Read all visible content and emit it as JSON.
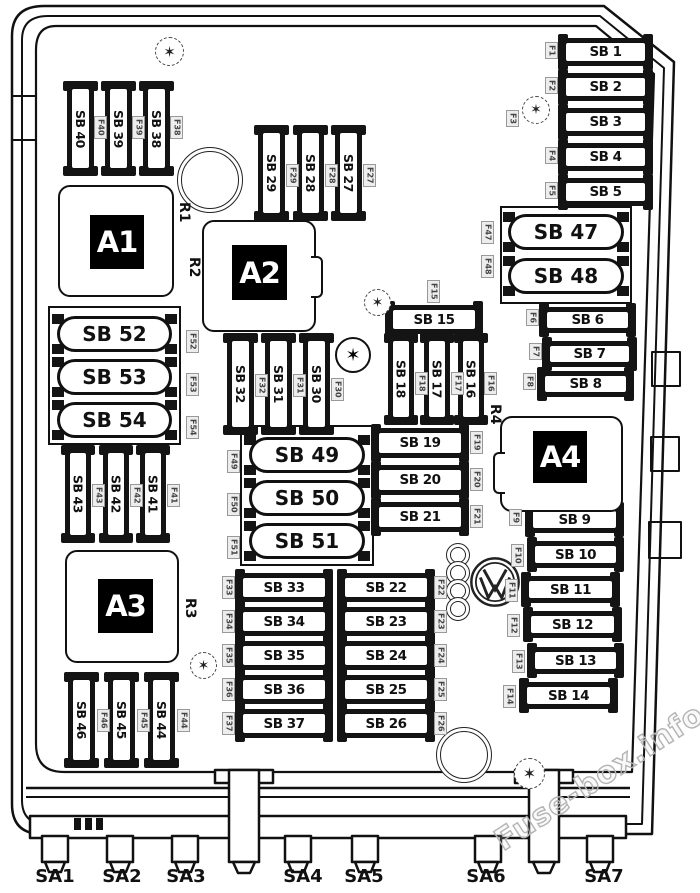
{
  "diagram": {
    "watermark": "Fuse-box.info",
    "icons": {
      "torx_glyph": "✶"
    },
    "colors": {
      "line": "#111111",
      "background": "#ffffff",
      "relay_bg": "#000000",
      "relay_text": "#ffffff",
      "id_label_bg": "#ededed",
      "id_label_text": "#444444",
      "watermark": "#b4b4b4"
    },
    "relays": [
      {
        "id": "A1",
        "x": 58,
        "y": 185,
        "w": 116,
        "h": 112,
        "cx": 30,
        "cy": 28,
        "cw": 54,
        "ch": 54
      },
      {
        "id": "A2",
        "x": 202,
        "y": 220,
        "w": 114,
        "h": 112,
        "cx": 28,
        "cy": 23,
        "cw": 55,
        "ch": 55,
        "tab": "right"
      },
      {
        "id": "A3",
        "x": 65,
        "y": 550,
        "w": 114,
        "h": 113,
        "cx": 31,
        "cy": 27,
        "cw": 55,
        "ch": 54
      },
      {
        "id": "A4",
        "x": 500,
        "y": 416,
        "w": 123,
        "h": 96,
        "cx": 31,
        "cy": 13,
        "cw": 54,
        "ch": 52,
        "tab": "left"
      }
    ],
    "relay_labels": [
      {
        "id": "R1",
        "x": 176,
        "y": 202
      },
      {
        "id": "R2",
        "x": 186,
        "y": 257
      },
      {
        "id": "R3",
        "x": 182,
        "y": 598
      },
      {
        "id": "R4",
        "x": 487,
        "y": 404
      }
    ],
    "vertical_fuses": [
      {
        "label": "SB 40",
        "x": 67,
        "y": 84,
        "w": 27,
        "h": 89,
        "f": {
          "label": "F40",
          "x": 94,
          "y": 116
        }
      },
      {
        "label": "SB 39",
        "x": 105,
        "y": 84,
        "w": 27,
        "h": 89,
        "f": {
          "label": "F39",
          "x": 132,
          "y": 116
        }
      },
      {
        "label": "SB 38",
        "x": 143,
        "y": 84,
        "w": 27,
        "h": 89,
        "f": {
          "label": "F38",
          "x": 170,
          "y": 116
        }
      },
      {
        "label": "SB 29",
        "x": 258,
        "y": 128,
        "w": 27,
        "h": 90,
        "f": {
          "label": "F29",
          "x": 286,
          "y": 164
        }
      },
      {
        "label": "SB 28",
        "x": 297,
        "y": 128,
        "w": 27,
        "h": 90,
        "f": {
          "label": "F28",
          "x": 325,
          "y": 164
        }
      },
      {
        "label": "SB 27",
        "x": 335,
        "y": 128,
        "w": 27,
        "h": 90,
        "f": {
          "label": "F27",
          "x": 363,
          "y": 164
        }
      },
      {
        "label": "SB 32",
        "x": 227,
        "y": 336,
        "w": 27,
        "h": 96,
        "f": {
          "label": "F32",
          "x": 255,
          "y": 374
        }
      },
      {
        "label": "SB 31",
        "x": 265,
        "y": 336,
        "w": 27,
        "h": 96,
        "f": {
          "label": "F31",
          "x": 293,
          "y": 374
        }
      },
      {
        "label": "SB 30",
        "x": 303,
        "y": 336,
        "w": 27,
        "h": 96,
        "f": {
          "label": "F30",
          "x": 331,
          "y": 378
        }
      },
      {
        "label": "SB 18",
        "x": 388,
        "y": 336,
        "w": 26,
        "h": 86,
        "f": {
          "label": "F18",
          "x": 415,
          "y": 372
        }
      },
      {
        "label": "SB 17",
        "x": 424,
        "y": 336,
        "w": 26,
        "h": 86,
        "f": {
          "label": "F17",
          "x": 451,
          "y": 372
        }
      },
      {
        "label": "SB 16",
        "x": 458,
        "y": 336,
        "w": 26,
        "h": 86,
        "f": {
          "label": "F16",
          "x": 484,
          "y": 372
        }
      },
      {
        "label": "SB 43",
        "x": 65,
        "y": 448,
        "w": 26,
        "h": 92,
        "f": {
          "label": "F43",
          "x": 92,
          "y": 484
        }
      },
      {
        "label": "SB 42",
        "x": 103,
        "y": 448,
        "w": 26,
        "h": 92,
        "f": {
          "label": "F42",
          "x": 130,
          "y": 484
        }
      },
      {
        "label": "SB 41",
        "x": 140,
        "y": 448,
        "w": 26,
        "h": 92,
        "f": {
          "label": "F41",
          "x": 167,
          "y": 484
        }
      },
      {
        "label": "SB 46",
        "x": 68,
        "y": 675,
        "w": 27,
        "h": 90,
        "f": {
          "label": "F46",
          "x": 97,
          "y": 709
        }
      },
      {
        "label": "SB 45",
        "x": 108,
        "y": 675,
        "w": 27,
        "h": 90,
        "f": {
          "label": "F45",
          "x": 137,
          "y": 709
        }
      },
      {
        "label": "SB 44",
        "x": 148,
        "y": 675,
        "w": 27,
        "h": 90,
        "f": {
          "label": "F44",
          "x": 177,
          "y": 709
        }
      }
    ],
    "horizontal_fuses": [
      {
        "label": "SB 1",
        "x": 561,
        "y": 38,
        "w": 89,
        "h": 28,
        "f": {
          "label": "F1",
          "x": 545,
          "y": 42
        }
      },
      {
        "label": "SB 2",
        "x": 561,
        "y": 73,
        "w": 89,
        "h": 28,
        "f": {
          "label": "F2",
          "x": 545,
          "y": 77
        }
      },
      {
        "label": "SB 3",
        "x": 561,
        "y": 108,
        "w": 89,
        "h": 28,
        "f": {
          "label": "F3",
          "x": 506,
          "y": 110
        }
      },
      {
        "label": "SB 4",
        "x": 561,
        "y": 143,
        "w": 89,
        "h": 28,
        "f": {
          "label": "F4",
          "x": 545,
          "y": 147
        }
      },
      {
        "label": "SB 5",
        "x": 561,
        "y": 178,
        "w": 89,
        "h": 28,
        "f": {
          "label": "F5",
          "x": 545,
          "y": 182
        }
      },
      {
        "label": "SB 6",
        "x": 542,
        "y": 307,
        "w": 91,
        "h": 26,
        "f": {
          "label": "F6",
          "x": 526,
          "y": 309
        }
      },
      {
        "label": "SB 7",
        "x": 545,
        "y": 341,
        "w": 89,
        "h": 26,
        "f": {
          "label": "F7",
          "x": 529,
          "y": 343
        }
      },
      {
        "label": "SB 8",
        "x": 540,
        "y": 371,
        "w": 91,
        "h": 26,
        "f": {
          "label": "F8",
          "x": 523,
          "y": 373
        }
      },
      {
        "label": "SB 15",
        "x": 388,
        "y": 305,
        "w": 92,
        "h": 29,
        "f": {
          "label": "F15",
          "x": 427,
          "y": 280
        }
      },
      {
        "label": "SB 19",
        "x": 374,
        "y": 428,
        "w": 92,
        "h": 30,
        "f": {
          "label": "F19",
          "x": 470,
          "y": 431
        }
      },
      {
        "label": "SB 20",
        "x": 374,
        "y": 465,
        "w": 92,
        "h": 30,
        "f": {
          "label": "F20",
          "x": 470,
          "y": 468
        }
      },
      {
        "label": "SB 21",
        "x": 374,
        "y": 502,
        "w": 92,
        "h": 30,
        "f": {
          "label": "F21",
          "x": 470,
          "y": 505
        }
      },
      {
        "label": "SB 33",
        "x": 238,
        "y": 573,
        "w": 92,
        "h": 29,
        "f": {
          "label": "F33",
          "x": 222,
          "y": 576
        }
      },
      {
        "label": "SB 34",
        "x": 238,
        "y": 607,
        "w": 92,
        "h": 29,
        "f": {
          "label": "F34",
          "x": 222,
          "y": 610
        }
      },
      {
        "label": "SB 35",
        "x": 238,
        "y": 641,
        "w": 92,
        "h": 29,
        "f": {
          "label": "F35",
          "x": 222,
          "y": 644
        }
      },
      {
        "label": "SB 36",
        "x": 238,
        "y": 675,
        "w": 92,
        "h": 29,
        "f": {
          "label": "F36",
          "x": 222,
          "y": 678
        }
      },
      {
        "label": "SB 37",
        "x": 238,
        "y": 709,
        "w": 92,
        "h": 29,
        "f": {
          "label": "F37",
          "x": 222,
          "y": 712
        }
      },
      {
        "label": "SB 22",
        "x": 340,
        "y": 573,
        "w": 92,
        "h": 29,
        "f": {
          "label": "F22",
          "x": 434,
          "y": 576
        }
      },
      {
        "label": "SB 23",
        "x": 340,
        "y": 607,
        "w": 92,
        "h": 29,
        "f": {
          "label": "F23",
          "x": 434,
          "y": 610
        }
      },
      {
        "label": "SB 24",
        "x": 340,
        "y": 641,
        "w": 92,
        "h": 29,
        "f": {
          "label": "F24",
          "x": 434,
          "y": 644
        }
      },
      {
        "label": "SB 25",
        "x": 340,
        "y": 675,
        "w": 92,
        "h": 29,
        "f": {
          "label": "F25",
          "x": 434,
          "y": 678
        }
      },
      {
        "label": "SB 26",
        "x": 340,
        "y": 709,
        "w": 92,
        "h": 29,
        "f": {
          "label": "F26",
          "x": 434,
          "y": 712
        }
      },
      {
        "label": "SB 9",
        "x": 528,
        "y": 506,
        "w": 93,
        "h": 27,
        "f": {
          "label": "F9",
          "x": 509,
          "y": 509
        }
      },
      {
        "label": "SB 10",
        "x": 530,
        "y": 541,
        "w": 91,
        "h": 27,
        "f": {
          "label": "F10",
          "x": 511,
          "y": 544
        }
      },
      {
        "label": "SB 11",
        "x": 524,
        "y": 576,
        "w": 93,
        "h": 27,
        "f": {
          "label": "F11",
          "x": 505,
          "y": 579
        }
      },
      {
        "label": "SB 12",
        "x": 526,
        "y": 611,
        "w": 93,
        "h": 27,
        "f": {
          "label": "F12",
          "x": 507,
          "y": 614
        }
      },
      {
        "label": "SB 13",
        "x": 530,
        "y": 647,
        "w": 91,
        "h": 27,
        "f": {
          "label": "F13",
          "x": 512,
          "y": 650
        }
      },
      {
        "label": "SB 14",
        "x": 522,
        "y": 682,
        "w": 93,
        "h": 27,
        "f": {
          "label": "F14",
          "x": 503,
          "y": 685
        }
      }
    ],
    "pill_groups": [
      {
        "id": "sb47-48",
        "x": 500,
        "y": 206,
        "w": 132,
        "h": 98,
        "pills": [
          {
            "label": "SB 47",
            "x": 508,
            "y": 214,
            "w": 116,
            "h": 36,
            "f": {
              "label": "F47",
              "x": 481,
              "y": 221
            }
          },
          {
            "label": "SB 48",
            "x": 508,
            "y": 258,
            "w": 116,
            "h": 36,
            "f": {
              "label": "F48",
              "x": 481,
              "y": 255
            }
          }
        ]
      },
      {
        "id": "sb52-54",
        "x": 48,
        "y": 306,
        "w": 133,
        "h": 139,
        "pills": [
          {
            "label": "SB 52",
            "x": 57,
            "y": 316,
            "w": 115,
            "h": 36,
            "f": {
              "label": "F52",
              "x": 186,
              "y": 330
            }
          },
          {
            "label": "SB 53",
            "x": 57,
            "y": 359,
            "w": 115,
            "h": 36,
            "f": {
              "label": "F53",
              "x": 186,
              "y": 373
            }
          },
          {
            "label": "SB 54",
            "x": 57,
            "y": 402,
            "w": 115,
            "h": 36,
            "f": {
              "label": "F54",
              "x": 186,
              "y": 416
            }
          }
        ]
      },
      {
        "id": "sb49-51",
        "x": 240,
        "y": 425,
        "w": 134,
        "h": 141,
        "pills": [
          {
            "label": "SB 49",
            "x": 249,
            "y": 437,
            "w": 116,
            "h": 36,
            "f": {
              "label": "F49",
              "x": 227,
              "y": 450
            }
          },
          {
            "label": "SB 50",
            "x": 249,
            "y": 480,
            "w": 116,
            "h": 36,
            "f": {
              "label": "F50",
              "x": 227,
              "y": 493
            }
          },
          {
            "label": "SB 51",
            "x": 249,
            "y": 523,
            "w": 116,
            "h": 36,
            "f": {
              "label": "F51",
              "x": 227,
              "y": 536
            }
          }
        ]
      }
    ],
    "screws": [
      {
        "x": 155,
        "y": 37,
        "d": 29,
        "style": "dashed"
      },
      {
        "x": 522,
        "y": 96,
        "d": 28,
        "style": "dashed"
      },
      {
        "x": 364,
        "y": 289,
        "d": 27,
        "style": "dashed"
      },
      {
        "x": 335,
        "y": 337,
        "d": 36,
        "style": "solid"
      },
      {
        "x": 190,
        "y": 652,
        "d": 27,
        "style": "dashed"
      },
      {
        "x": 514,
        "y": 758,
        "d": 31,
        "style": "dashed"
      }
    ],
    "circles": [
      {
        "x": 177,
        "y": 147,
        "d": 66
      },
      {
        "x": 436,
        "y": 727,
        "d": 56
      }
    ],
    "audi_rings": {
      "x": 446,
      "d": 24,
      "ys": [
        543,
        561,
        579,
        597
      ]
    },
    "vw_logo": {
      "x": 468,
      "y": 555,
      "d": 54
    },
    "sa_connectors": [
      {
        "label": "SA1",
        "x": 55
      },
      {
        "label": "SA2",
        "x": 122
      },
      {
        "label": "SA3",
        "x": 186
      },
      {
        "label": "SA4",
        "x": 303
      },
      {
        "label": "SA5",
        "x": 364
      },
      {
        "label": "SA6",
        "x": 486
      },
      {
        "label": "SA7",
        "x": 604
      }
    ]
  }
}
